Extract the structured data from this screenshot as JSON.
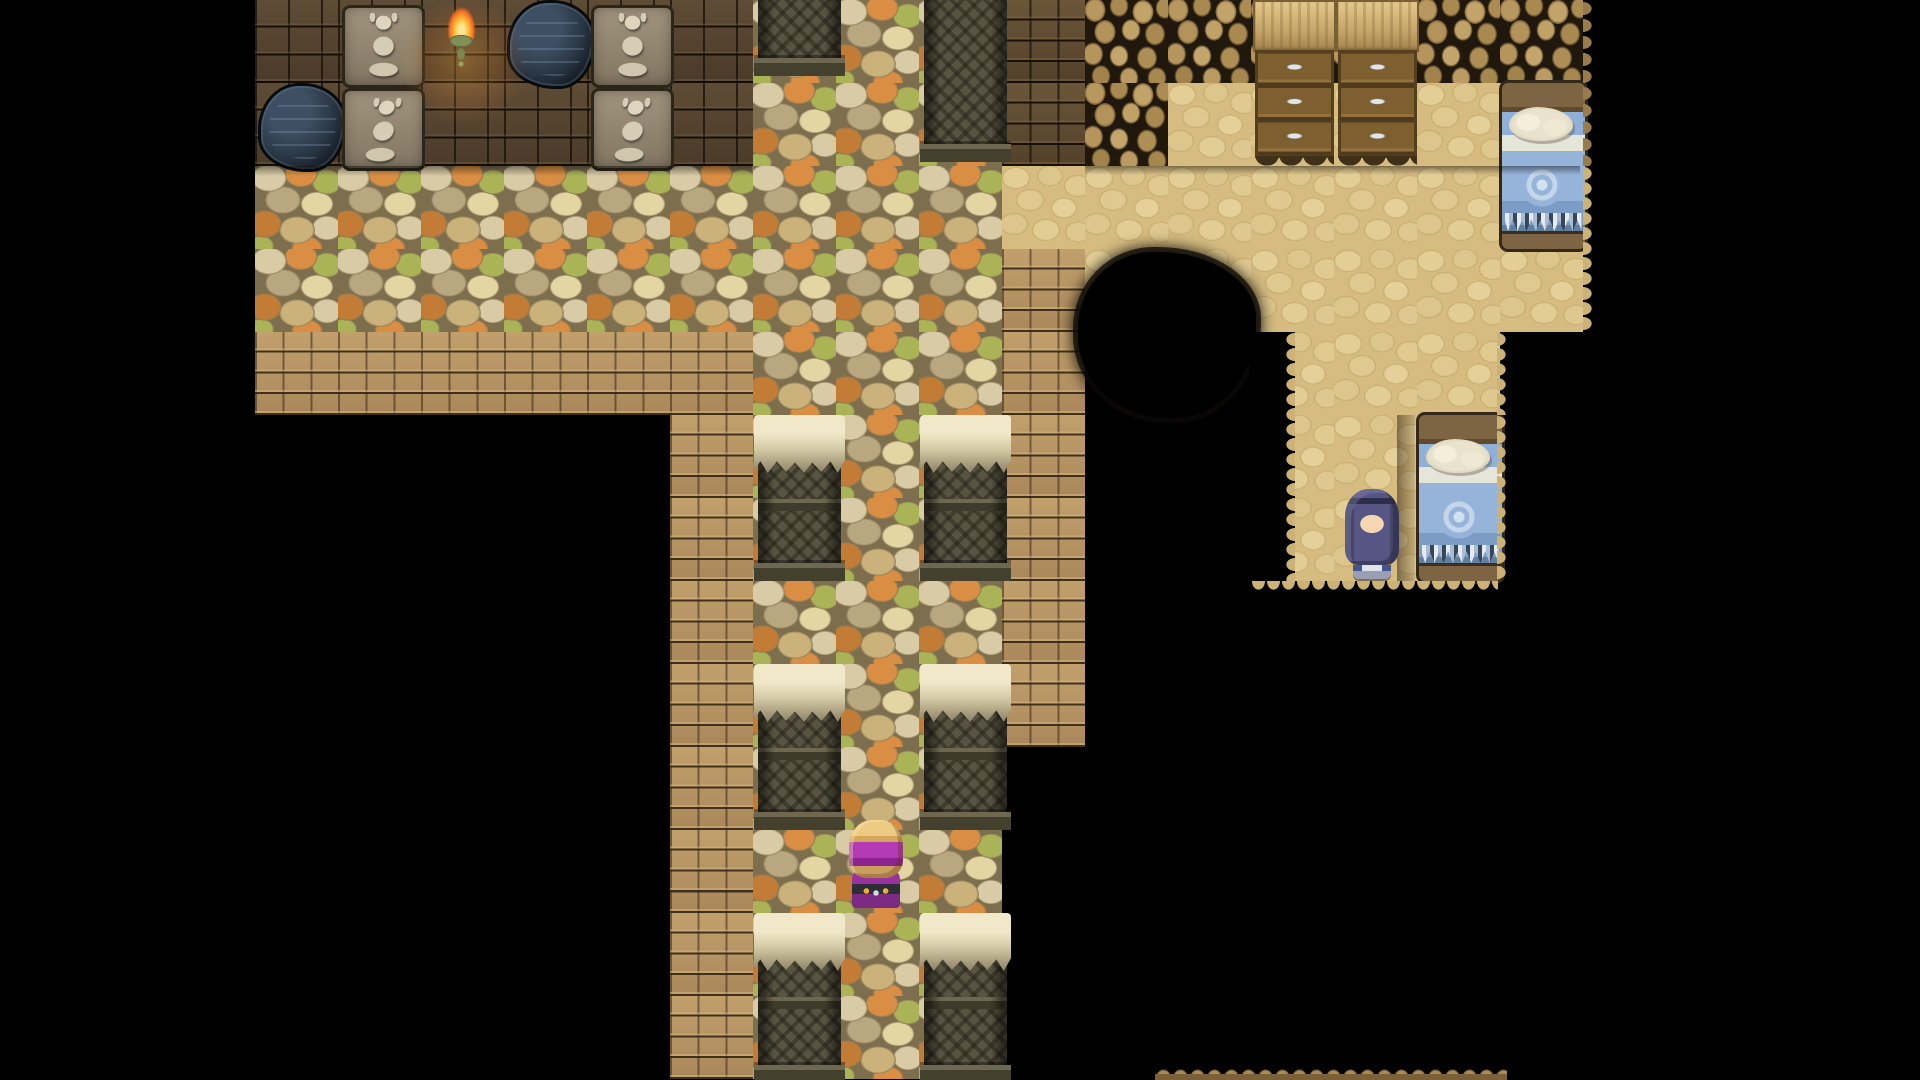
{
  "scene": {
    "title": "rpg-cave-interior-map",
    "viewport": {
      "width": 1920,
      "height": 1080
    },
    "tile_size": 83,
    "origin_x": 255,
    "origin_y": 0,
    "background_color": "#000000"
  },
  "palette": {
    "void": "#000000",
    "dark_wall_brick": "#4c3b29",
    "tan_brick_path": "#b3925f",
    "dark_interior_brick": "#5e4a30",
    "pebble_mortar": "#7d6e4e",
    "pebble_orange": "#d98e44",
    "pebble_olive": "#aab457",
    "pebble_cream": "#d8cba5",
    "dirt_floor": "#d6bc80",
    "rock_wall_dark": "#20180d",
    "rock_bump": "#b8985f",
    "torch_flame": "#ff9c2c",
    "torch_sconce": "#4e7a52",
    "bed_blanket_blue": "#8fb0d8",
    "bed_pillow": "#efe9d6",
    "cabinet_wood": "#7d5e2e",
    "pillar_stone": "#595442",
    "pillar_cap": "#e6ddba",
    "girl_hair": "#565684",
    "girl_outfit": "#44548c",
    "turban_purple": "#b23ab4",
    "turban_hair": "#ecca82"
  },
  "legend": {
    "K": {
      "name": "void-tile"
    },
    "W": {
      "name": "dark-wall-tile"
    },
    "B": {
      "name": "brick-path-tile"
    },
    "A": {
      "name": "interior-brick-tile"
    },
    "P": {
      "name": "pebble-floor-tile"
    },
    "D": {
      "name": "dirt-floor-tile"
    },
    "R": {
      "name": "rock-wall-tile"
    }
  },
  "map": [
    "WWWWWWPPPARRRRRR",
    "WWWWWWPPPARDDDDD",
    "PPPPPPPPPDDDDDDD",
    "PPPPPPPPPBDDDDDD",
    "BBBBBBPPPBKKDDDK",
    "KKKKKBPPPBKKDDDK",
    "KKKKKBPPPBKKDDDK",
    "KKKKKBPPPBKKKKKK",
    "KKKKKBPPPBKKKKKK",
    "KKKKKBPPPKKKKKKK",
    "KKKKKBPPPKKKKKKK",
    "KKKKKBPPPKKKKKKK",
    "KKKKKBPPPKKKKKKK"
  ],
  "objects": [
    {
      "type": "statue-sitting",
      "name": "sitting-statue",
      "col": 1,
      "row": 0,
      "w": 1,
      "h": 1
    },
    {
      "type": "torch",
      "name": "wall-torch",
      "col": 2,
      "row": 0,
      "w": 1,
      "h": 1
    },
    {
      "type": "hole",
      "name": "wall-hole",
      "col": 3,
      "row": 0,
      "w": 1,
      "h": 1
    },
    {
      "type": "statue-sitting",
      "name": "sitting-statue",
      "col": 4,
      "row": 0,
      "w": 1,
      "h": 1
    },
    {
      "type": "hole",
      "name": "wall-hole",
      "col": 0,
      "row": 1,
      "w": 1,
      "h": 1
    },
    {
      "type": "statue-crouching",
      "name": "crouching-statue",
      "col": 1,
      "row": 1,
      "w": 1,
      "h": 1
    },
    {
      "type": "statue-crouching",
      "name": "crouching-statue",
      "col": 4,
      "row": 1,
      "w": 1,
      "h": 1
    },
    {
      "type": "pillar-base",
      "name": "ruined-pillar-base",
      "col": 6,
      "row": 0,
      "w": 1,
      "h": 0.92
    },
    {
      "type": "pillar-base",
      "name": "ruined-pillar-base",
      "col": 8,
      "row": 0,
      "w": 1,
      "h": 1.95
    },
    {
      "type": "pillar",
      "name": "ruined-pillar",
      "col": 6,
      "row": 5,
      "w": 1,
      "h": 2
    },
    {
      "type": "pillar",
      "name": "ruined-pillar",
      "col": 8,
      "row": 5,
      "w": 1,
      "h": 2
    },
    {
      "type": "pillar",
      "name": "ruined-pillar",
      "col": 6,
      "row": 8,
      "w": 1,
      "h": 2
    },
    {
      "type": "pillar",
      "name": "ruined-pillar",
      "col": 8,
      "row": 8,
      "w": 1,
      "h": 2
    },
    {
      "type": "pillar",
      "name": "ruined-pillar",
      "col": 6,
      "row": 11,
      "w": 1,
      "h": 2.05
    },
    {
      "type": "pillar",
      "name": "ruined-pillar",
      "col": 8,
      "row": 11,
      "w": 1,
      "h": 2.05
    },
    {
      "type": "cabinet",
      "name": "wooden-dresser",
      "col": 12,
      "row": 0,
      "w": 1,
      "h": 2
    },
    {
      "type": "cabinet",
      "name": "wooden-dresser",
      "col": 13,
      "row": 0,
      "w": 1,
      "h": 2
    },
    {
      "type": "bed",
      "name": "bed-blue-blanket",
      "col": 15,
      "row": 1,
      "w": 1,
      "h": 2
    },
    {
      "type": "bed",
      "name": "bed-blue-blanket",
      "col": 14,
      "row": 5,
      "w": 1,
      "h": 2
    }
  ],
  "characters": [
    {
      "id": "npc-girl",
      "name": "purple-haired-girl",
      "desc": "long indigo hair, white and blue outfit, facing down",
      "x": 1343,
      "y": 489,
      "w": 58,
      "h": 90,
      "css": "ch-girl"
    },
    {
      "id": "player-turban",
      "name": "turban-adventurer",
      "desc": "sandy hair with purple turban wrap, seen from behind, facing up",
      "x": 846,
      "y": 820,
      "w": 60,
      "h": 88,
      "css": "ch-turban"
    }
  ],
  "overlays": [
    {
      "cls": "ov-glow",
      "name": "torch-glow",
      "x": 398,
      "y": 0,
      "w": 132,
      "h": 122
    },
    {
      "cls": "ov-shade-h",
      "name": "wall-base-shadow",
      "x": 255,
      "y": 166,
      "w": 497,
      "h": 10
    },
    {
      "cls": "ov-shade-h",
      "name": "wall-base-shadow",
      "x": 1085,
      "y": 166,
      "w": 495,
      "h": 9
    },
    {
      "cls": "ov-blob",
      "name": "void-blob",
      "x": 1078,
      "y": 252,
      "w": 178,
      "h": 166
    },
    {
      "cls": "ov-void",
      "name": "void-strip",
      "x": 1249,
      "y": 332,
      "w": 46,
      "h": 249
    },
    {
      "cls": "ov-teeth-left",
      "name": "dirt-torn-edge",
      "x": 1281,
      "y": 332,
      "w": 14,
      "h": 249
    },
    {
      "cls": "ov-teeth-down",
      "name": "dirt-torn-edge",
      "x": 1251,
      "y": 581,
      "w": 247,
      "h": 14
    },
    {
      "cls": "ov-teeth-right",
      "name": "dirt-torn-edge",
      "x": 1497,
      "y": 415,
      "w": 14,
      "h": 166
    },
    {
      "cls": "ov-teeth-right",
      "name": "dirt-torn-edge",
      "x": 1497,
      "y": 332,
      "w": 14,
      "h": 83
    },
    {
      "cls": "ov-teeth-right",
      "name": "dirt-torn-edge",
      "x": 1583,
      "y": 166,
      "w": 14,
      "h": 166
    },
    {
      "cls": "ov-teeth-right-rock",
      "name": "rock-torn-edge",
      "x": 1583,
      "y": 0,
      "w": 16,
      "h": 166
    },
    {
      "cls": "ov-shadow",
      "name": "bed-shadow-strip",
      "x": 1397,
      "y": 415,
      "w": 18,
      "h": 166
    },
    {
      "cls": "ov-rockstrip",
      "name": "bottom-rock-ledge",
      "x": 1155,
      "y": 1060,
      "w": 352,
      "h": 20
    }
  ]
}
